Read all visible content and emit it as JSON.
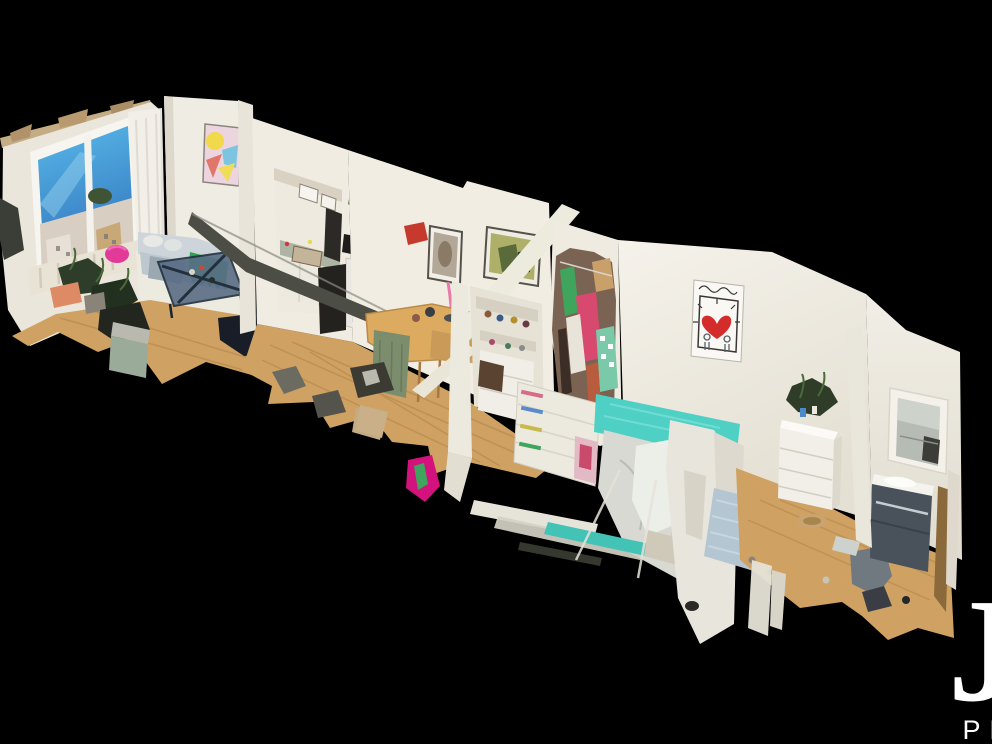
{
  "app": {
    "type": "3d-dollhouse-scan-view",
    "description": "Overhead cutaway dollhouse view of a scanned apartment floating on a black background, with ragged photogrammetry mesh edges at the bottom and a white brand watermark in the lower-right corner."
  },
  "watermark": {
    "initial": "J",
    "subtext": "PR",
    "color": "#ffffff"
  },
  "scene": {
    "rooms": [
      {
        "name": "living-room",
        "features": [
          "large window with blue sky and city buildings",
          "sheer white curtain",
          "pastel abstract painting",
          "grey sofa with white pillows",
          "green fringe banner on sofa",
          "dark glass coffee table",
          "pink pouf",
          "houseplants",
          "white rug",
          "radiator below window",
          "wood floor"
        ]
      },
      {
        "name": "kitchen-dining",
        "features": [
          "wall pass-through opening to kitchen",
          "kitchen counter with clutter",
          "fridge covered with magnets",
          "plant on top of fridge",
          "black cabinet",
          "wooden dining table with chairs",
          "green slip-covered chair",
          "two framed artworks",
          "red wall object",
          "brown suitcase",
          "dark cut-wall beam",
          "wood floor with debris"
        ]
      },
      {
        "name": "bedroom",
        "features": [
          "open wardrobe stuffed with colorful clothes",
          "white shelf with folded clothes",
          "bed with teal cover and white duvet",
          "framed heart print in Keith Haring style",
          "fragmented white cut walls",
          "teal rug fragment"
        ]
      },
      {
        "name": "second-bedroom",
        "features": [
          "white dresser with houseplant on top",
          "round tan pet basket",
          "grey chair",
          "light blue rug",
          "wood floor"
        ]
      },
      {
        "name": "bathroom",
        "features": [
          "recessed wall mirror with reflection",
          "dark vanity cabinet with white sink",
          "chrome trim",
          "wood floor"
        ]
      }
    ],
    "colors": {
      "background": "#000000",
      "wall": "#f0ece2",
      "wall_shadow": "#ddd8cb",
      "ceiling_edge": "#c4ad84",
      "floor_wood": "#cfa263",
      "floor_plank_line": "#b2834a",
      "window_sky_top": "#58b8e8",
      "window_sky_bottom": "#3c86c8",
      "window_buildings": "#d8cfc2",
      "art_pastel_pink": "#ecd5df",
      "art_yellow": "#f2d84b",
      "art_blue": "#7cc4e0",
      "art_coral": "#e2766a",
      "sofa_grey": "#c3cdd4",
      "banner_green": "#2fa352",
      "pouf_pink": "#e23a98",
      "coffee_table_dark": "#2e3d52",
      "fridge_white": "#e9e7e2",
      "table_wood": "#dcab60",
      "suitcase_brown": "#46311f",
      "clothes_pink": "#d8496f",
      "clothes_green": "#3fa45c",
      "bed_teal": "#4fd0c5",
      "duvet_white": "#d8d9d2",
      "heart_red": "#d42b2b",
      "rug_blue": "#b4c6d2",
      "rug_white": "#edeae0",
      "dresser_white": "#f1efe8",
      "vanity_dark": "#49525a",
      "basket_tan": "#c9a470",
      "watermark": "#ffffff"
    }
  }
}
